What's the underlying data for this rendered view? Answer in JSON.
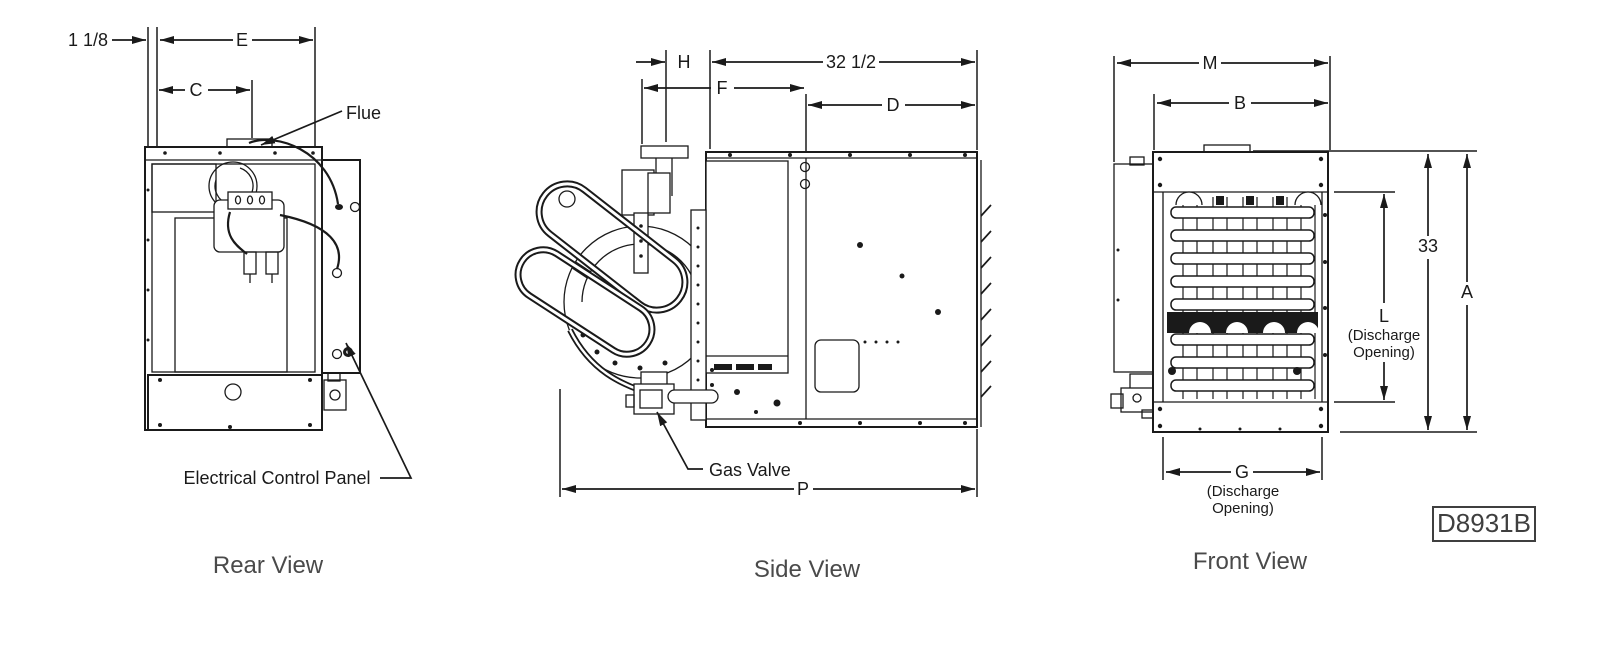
{
  "drawing_number": "D8931B",
  "rear_view": {
    "caption": "Rear View",
    "dim_offset": "1 1/8",
    "dim_e": "E",
    "dim_c": "C",
    "label_flue": "Flue",
    "label_electrical": "Electrical Control Panel"
  },
  "side_view": {
    "caption": "Side View",
    "dim_h": "H",
    "dim_width": "32 1/2",
    "dim_f": "F",
    "dim_d": "D",
    "dim_p": "P",
    "label_gas_valve": "Gas Valve"
  },
  "front_view": {
    "caption": "Front View",
    "dim_m": "M",
    "dim_b": "B",
    "dim_height": "33",
    "dim_a": "A",
    "dim_l": "L",
    "dim_l_note1": "(Discharge",
    "dim_l_note2": "Opening)",
    "dim_g": "G",
    "dim_g_note1": "(Discharge",
    "dim_g_note2": "Opening)"
  }
}
